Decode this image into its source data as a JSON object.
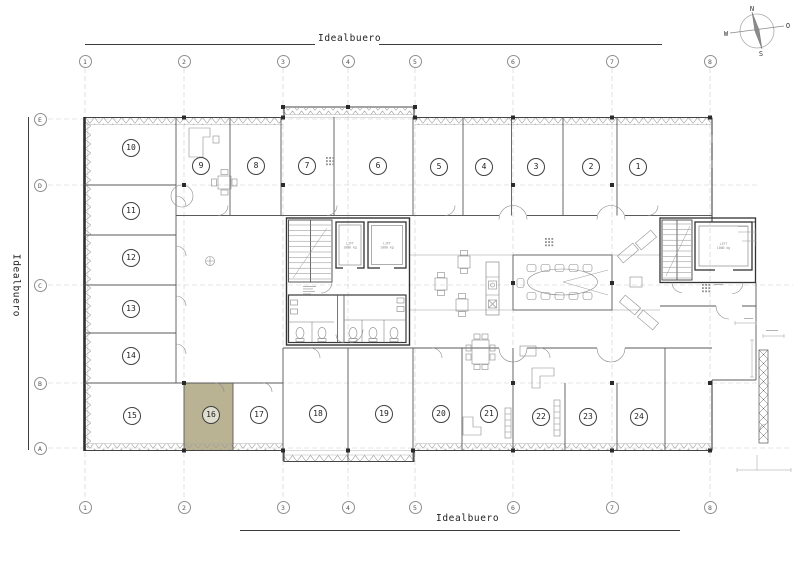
{
  "titles": {
    "top": "Idealbuero",
    "bottom": "Idealbuero",
    "left": "Idealbuero"
  },
  "compass": {
    "north": "N",
    "east": "O",
    "south": "S",
    "west": "W"
  },
  "grid": {
    "columns": [
      "1",
      "2",
      "3",
      "4",
      "5",
      "6",
      "7",
      "8"
    ],
    "rows": [
      "E",
      "D",
      "C",
      "B",
      "A"
    ]
  },
  "rooms": [
    "1",
    "2",
    "3",
    "4",
    "5",
    "6",
    "7",
    "8",
    "9",
    "10",
    "11",
    "12",
    "13",
    "14",
    "15",
    "16",
    "17",
    "18",
    "19",
    "20",
    "21",
    "22",
    "23",
    "24"
  ],
  "highlighted_room": "16",
  "lifts": {
    "label": "LIFT",
    "capacity": "1000 kg"
  },
  "colors": {
    "highlight": "#b9b393",
    "wall": "#3c3c3c",
    "furniture": "#8a8a8a",
    "grid_line": "#c9c9c9"
  }
}
